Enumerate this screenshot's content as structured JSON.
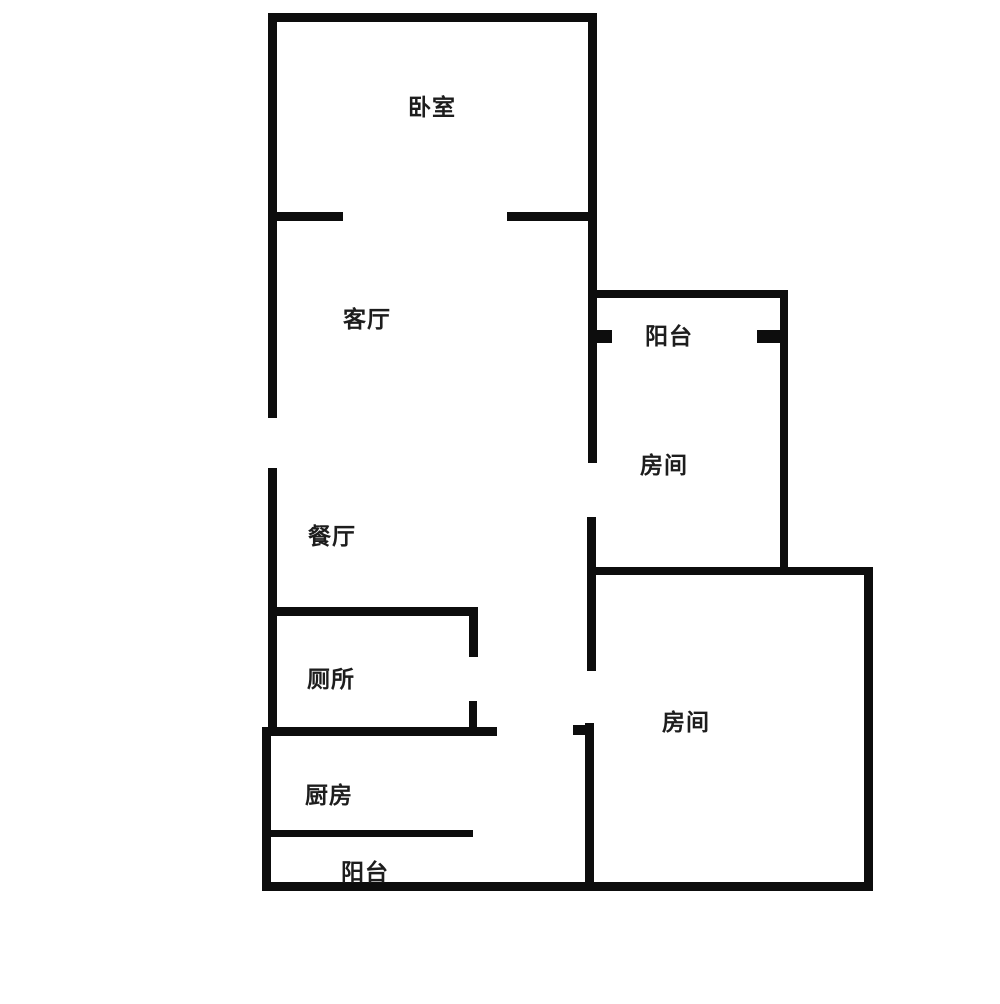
{
  "floor_plan": {
    "type": "apartment-floor-plan",
    "rooms": [
      {
        "id": "bedroom",
        "label": "卧室"
      },
      {
        "id": "living-room",
        "label": "客厅"
      },
      {
        "id": "balcony-upper",
        "label": "阳台"
      },
      {
        "id": "room-right-upper",
        "label": "房间"
      },
      {
        "id": "dining-room",
        "label": "餐厅"
      },
      {
        "id": "toilet",
        "label": "厕所"
      },
      {
        "id": "room-right-lower",
        "label": "房间"
      },
      {
        "id": "kitchen",
        "label": "厨房"
      },
      {
        "id": "balcony-lower",
        "label": "阳台"
      }
    ],
    "colors": {
      "wall": "#0d0d0d",
      "text": "#1d1d1d",
      "background": "#ffffff"
    }
  }
}
